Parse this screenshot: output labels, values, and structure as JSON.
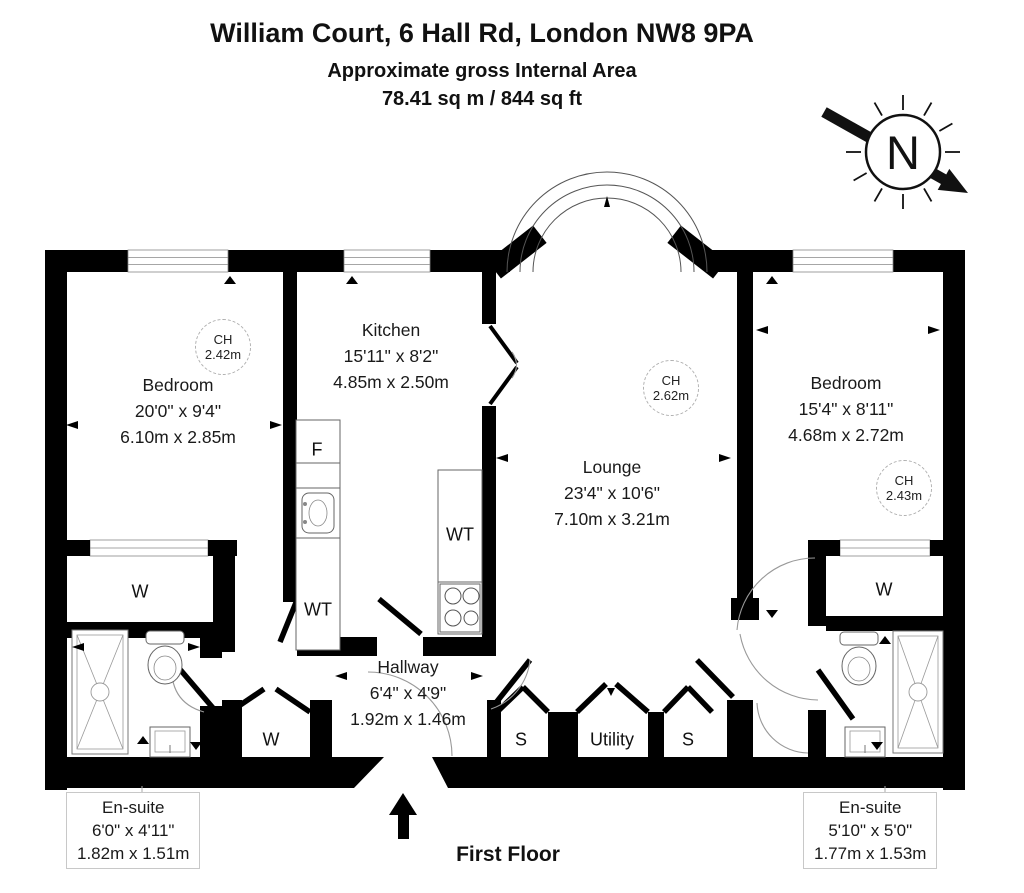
{
  "header": {
    "title": "William Court, 6 Hall Rd, London NW8 9PA",
    "subtitle": "Approximate gross Internal Area",
    "area": "78.41 sq m / 844 sq ft"
  },
  "compass": {
    "north_label": "N"
  },
  "floor_label": "First Floor",
  "rooms": {
    "bedroom_left": {
      "name": "Bedroom",
      "imperial": "20'0\" x 9'4\"",
      "metric": "6.10m x 2.85m",
      "ch_label": "CH",
      "ch_value": "2.42m"
    },
    "kitchen": {
      "name": "Kitchen",
      "imperial": "15'11\" x 8'2\"",
      "metric": "4.85m x 2.50m"
    },
    "lounge": {
      "name": "Lounge",
      "imperial": "23'4\" x 10'6\"",
      "metric": "7.10m x 3.21m",
      "ch_label": "CH",
      "ch_value": "2.62m"
    },
    "bedroom_right": {
      "name": "Bedroom",
      "imperial": "15'4\" x 8'11\"",
      "metric": "4.68m x 2.72m",
      "ch_label": "CH",
      "ch_value": "2.43m"
    },
    "hallway": {
      "name": "Hallway",
      "imperial": "6'4\" x 4'9\"",
      "metric": "1.92m x 1.46m"
    },
    "ensuite_left": {
      "name": "En-suite",
      "imperial": "6'0\" x 4'11\"",
      "metric": "1.82m x 1.51m"
    },
    "ensuite_right": {
      "name": "En-suite",
      "imperial": "5'10\" x 5'0\"",
      "metric": "1.77m x 1.53m"
    }
  },
  "fixtures": {
    "fridge": "F",
    "washer_kitchen_left": "WT",
    "washer_kitchen_right": "WT",
    "wardrobe_left": "W",
    "closet_hall": "W",
    "wardrobe_right": "W",
    "store_left": "S",
    "utility": "Utility",
    "store_right": "S"
  },
  "colors": {
    "wall": "#000000",
    "background": "#ffffff",
    "callout_border": "#c8c8c8",
    "dashed_circle_border": "#b0b0b0"
  }
}
